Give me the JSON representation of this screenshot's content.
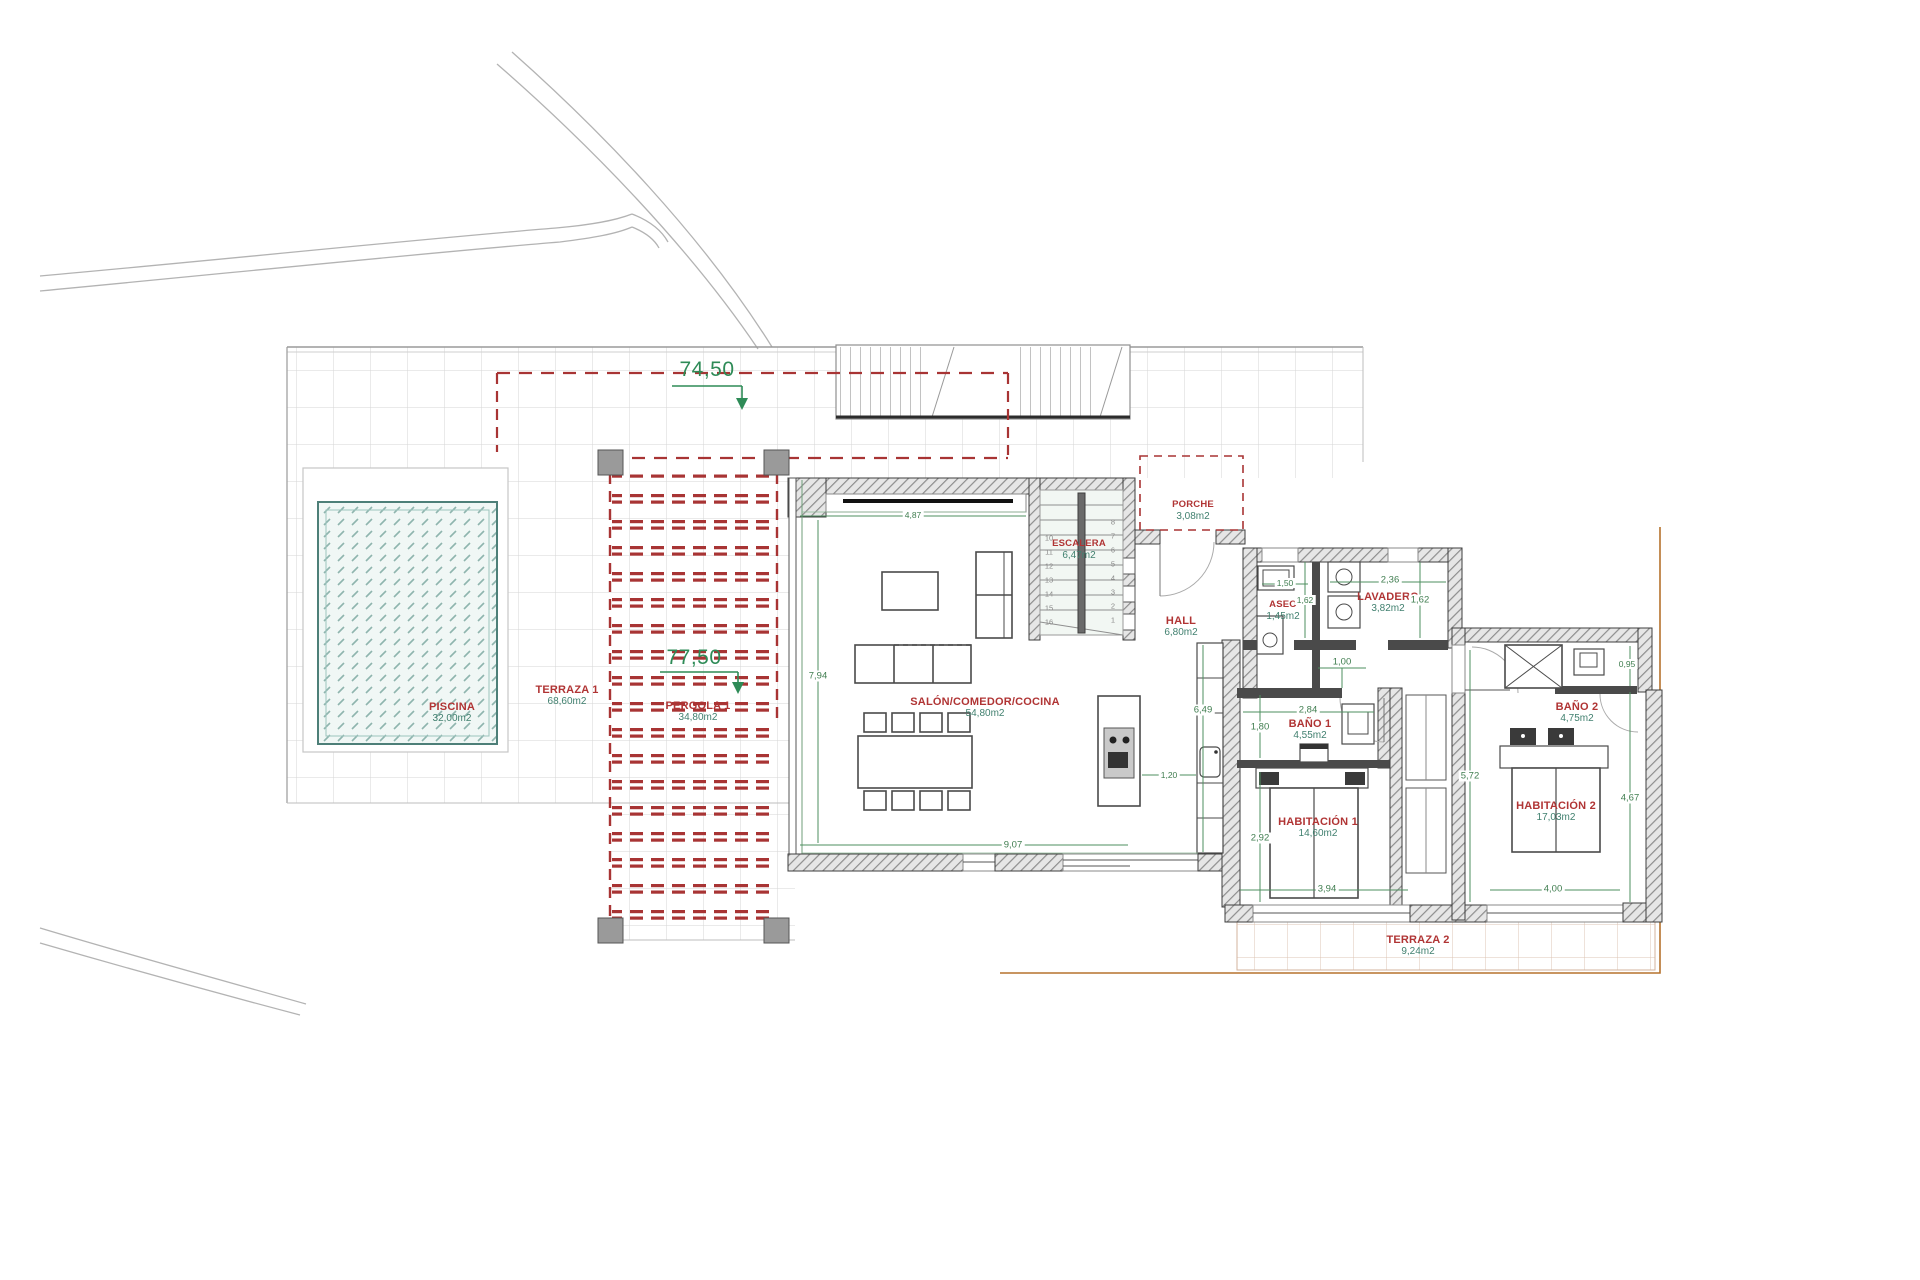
{
  "document": {
    "type": "villa ground floor plan"
  },
  "levels": {
    "terrace": "74,50",
    "pergola": "77,50"
  },
  "rooms": {
    "piscina": {
      "name": "PISCINA",
      "area": "32,00m2"
    },
    "terraza1": {
      "name": "TERRAZA 1",
      "area": "68,60m2"
    },
    "pergola1": {
      "name": "PERGOLA 1",
      "area": "34,80m2"
    },
    "salon": {
      "name": "SALÓN/COMEDOR/COCINA",
      "area": "54,80m2"
    },
    "escalera": {
      "name": "ESCALERA",
      "area": "6,47m2"
    },
    "porche": {
      "name": "PORCHE",
      "area": "3,08m2"
    },
    "hall": {
      "name": "HALL",
      "area": "6,80m2"
    },
    "aseo": {
      "name": "ASEO",
      "area": "1,45m2"
    },
    "lavadero": {
      "name": "LAVADERO",
      "area": "3,82m2"
    },
    "bano1": {
      "name": "BAÑO 1",
      "area": "4,55m2"
    },
    "habitacion1": {
      "name": "HABITACIÓN 1",
      "area": "14,60m2"
    },
    "bano2": {
      "name": "BAÑO 2",
      "area": "4,75m2"
    },
    "habitacion2": {
      "name": "HABITACIÓN 2",
      "area": "17,03m2"
    },
    "terraza2": {
      "name": "TERRAZA 2",
      "area": "9,24m2"
    }
  },
  "dimensions": {
    "salon_top": "4,87",
    "salon_left": "7,94",
    "salon_bottom": "9,07",
    "island_gap": "1,20",
    "kitchen_height": "6,49",
    "hall_pass": "1,00",
    "aseo_width": "1,50",
    "aseo_depth": "1,62",
    "lavadero_width": "2,36",
    "lavadero_depth": "1,62",
    "bano1_width": "2,84",
    "bano1_depth": "1,80",
    "hab1_depth": "2,92",
    "hab1_width": "3,94",
    "hab2_width": "4,00",
    "hab2_left": "5,72",
    "hab2_right": "4,67",
    "bano2_niche": "0,95"
  },
  "stairs": {
    "steps_left": [
      "10",
      "11",
      "12",
      "13",
      "14",
      "15",
      "16"
    ],
    "steps_right": [
      "8",
      "7",
      "6",
      "5",
      "4",
      "3",
      "2",
      "1"
    ]
  },
  "colors": {
    "dimension_green": "#3f7d4f",
    "level_green": "#2e8b57",
    "label_red": "#b03434",
    "area_teal": "#41806f",
    "pergola_red": "#a83434",
    "boundary_brown": "#b5722d",
    "pool_teal": "#4d7f78",
    "wall_dark": "#3d3d3d"
  }
}
